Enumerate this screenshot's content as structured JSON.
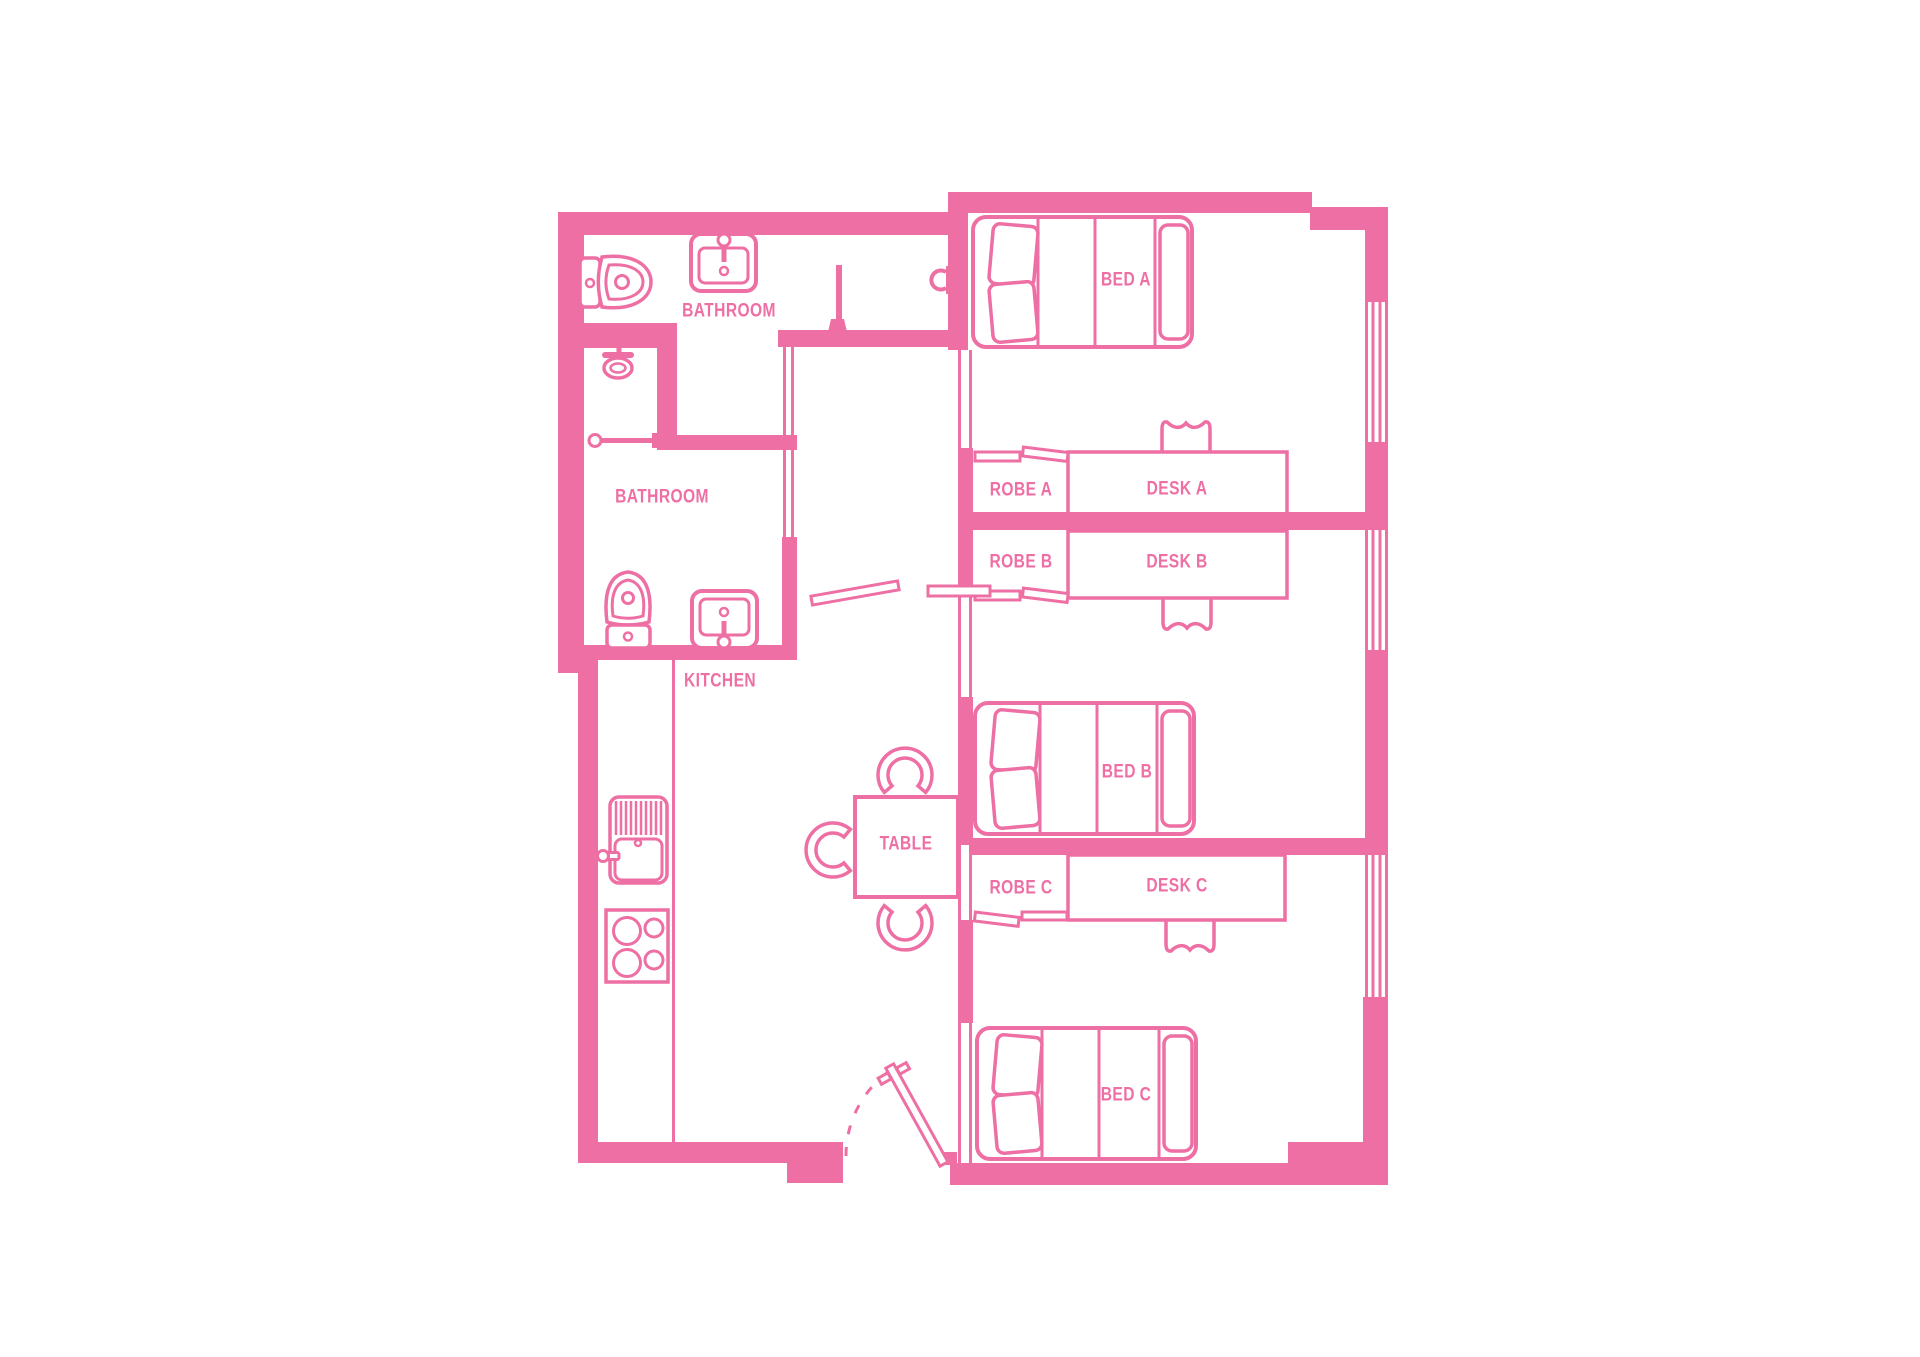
{
  "colors": {
    "accent": "#ee6fa4",
    "background": "#ffffff"
  },
  "plan": {
    "bathrooms": [
      {
        "label": "BATHROOM"
      },
      {
        "label": "BATHROOM"
      }
    ],
    "kitchen": {
      "label": "KITCHEN"
    },
    "dining": {
      "table_label": "TABLE"
    },
    "bedrooms": [
      {
        "bed_label": "BED A",
        "desk_label": "DESK A",
        "robe_label": "ROBE A"
      },
      {
        "bed_label": "BED B",
        "desk_label": "DESK B",
        "robe_label": "ROBE B"
      },
      {
        "bed_label": "BED C",
        "desk_label": "DESK C",
        "robe_label": "ROBE C"
      }
    ]
  }
}
